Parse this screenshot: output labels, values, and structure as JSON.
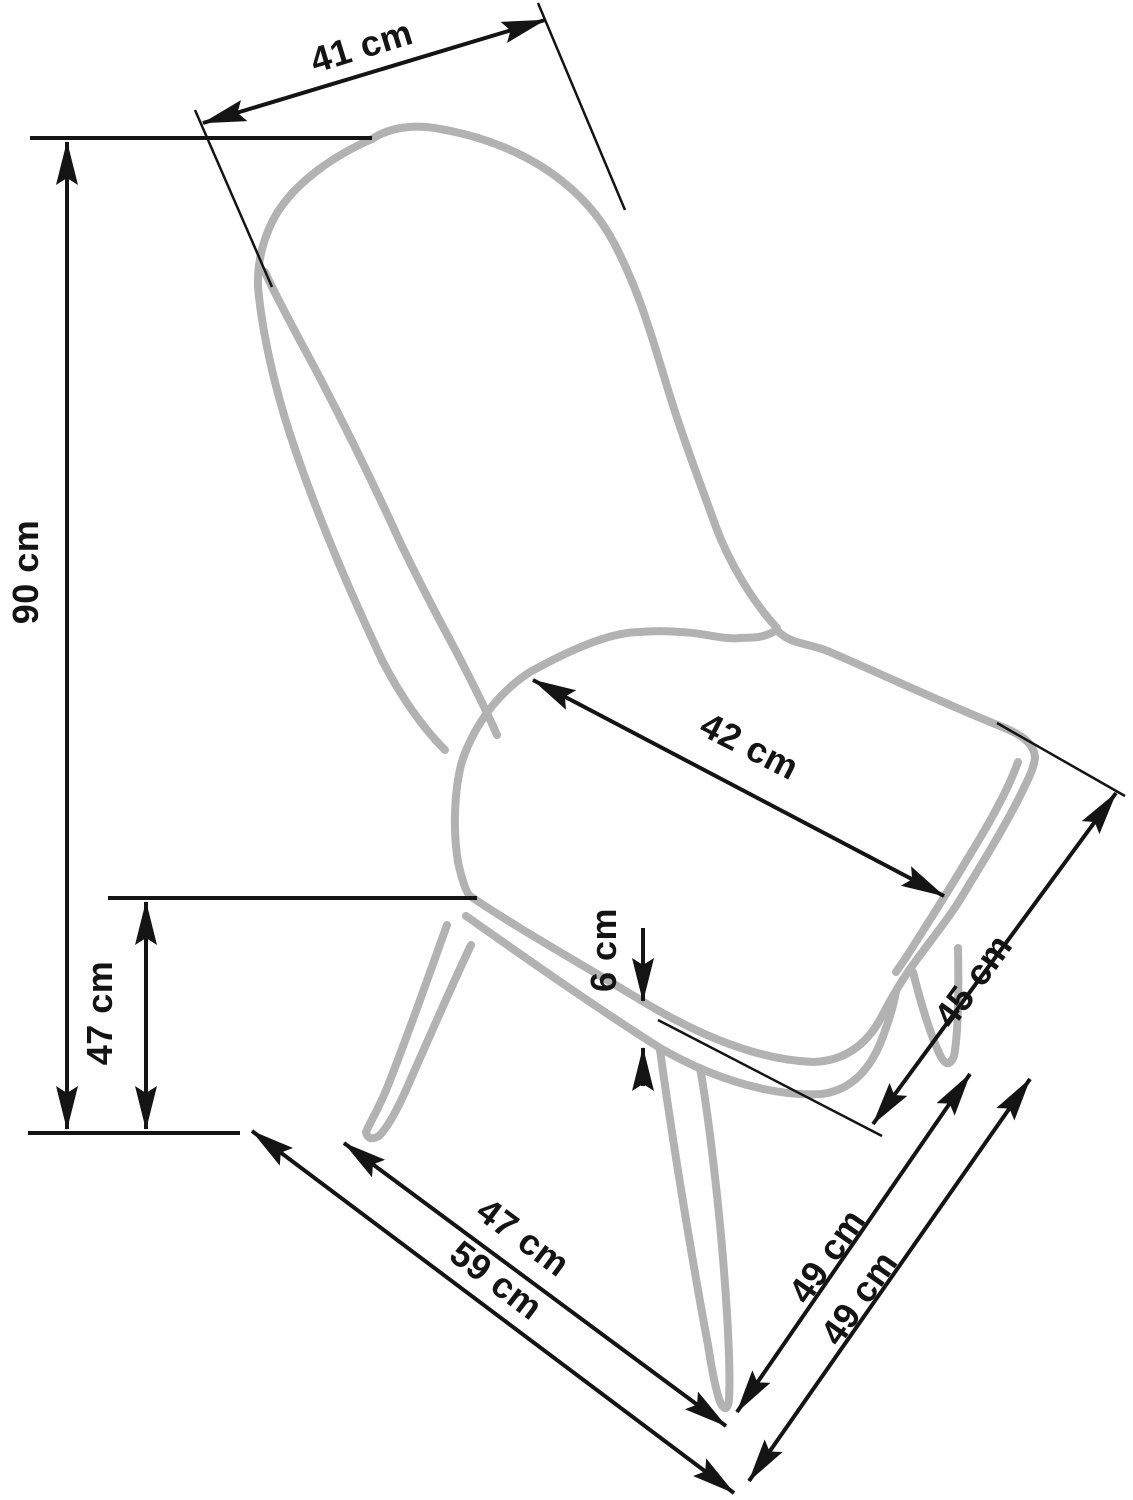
{
  "drawing": {
    "object": "dining-chair technical line drawing, three-quarter view",
    "unit": "cm"
  },
  "colors": {
    "chair_outline": "#b2b2b2",
    "dimension_lines": "#141414",
    "background": "#ffffff"
  },
  "dims": {
    "backrest_top_width": {
      "label": "41 cm",
      "value": 41
    },
    "total_height": {
      "label": "90 cm",
      "value": 90
    },
    "seat_height": {
      "label": "47 cm",
      "value": 47
    },
    "seat_width": {
      "label": "42 cm",
      "value": 42
    },
    "cushion_thickness": {
      "label": "6 cm",
      "value": 6
    },
    "seat_depth": {
      "label": "45 cm",
      "value": 45
    },
    "front_width": {
      "label": "47 cm",
      "value": 47
    },
    "base_width": {
      "label": "59 cm",
      "value": 59
    },
    "base_depth_inner": {
      "label": "49 cm",
      "value": 49
    },
    "base_depth_outer": {
      "label": "49 cm",
      "value": 49
    }
  }
}
